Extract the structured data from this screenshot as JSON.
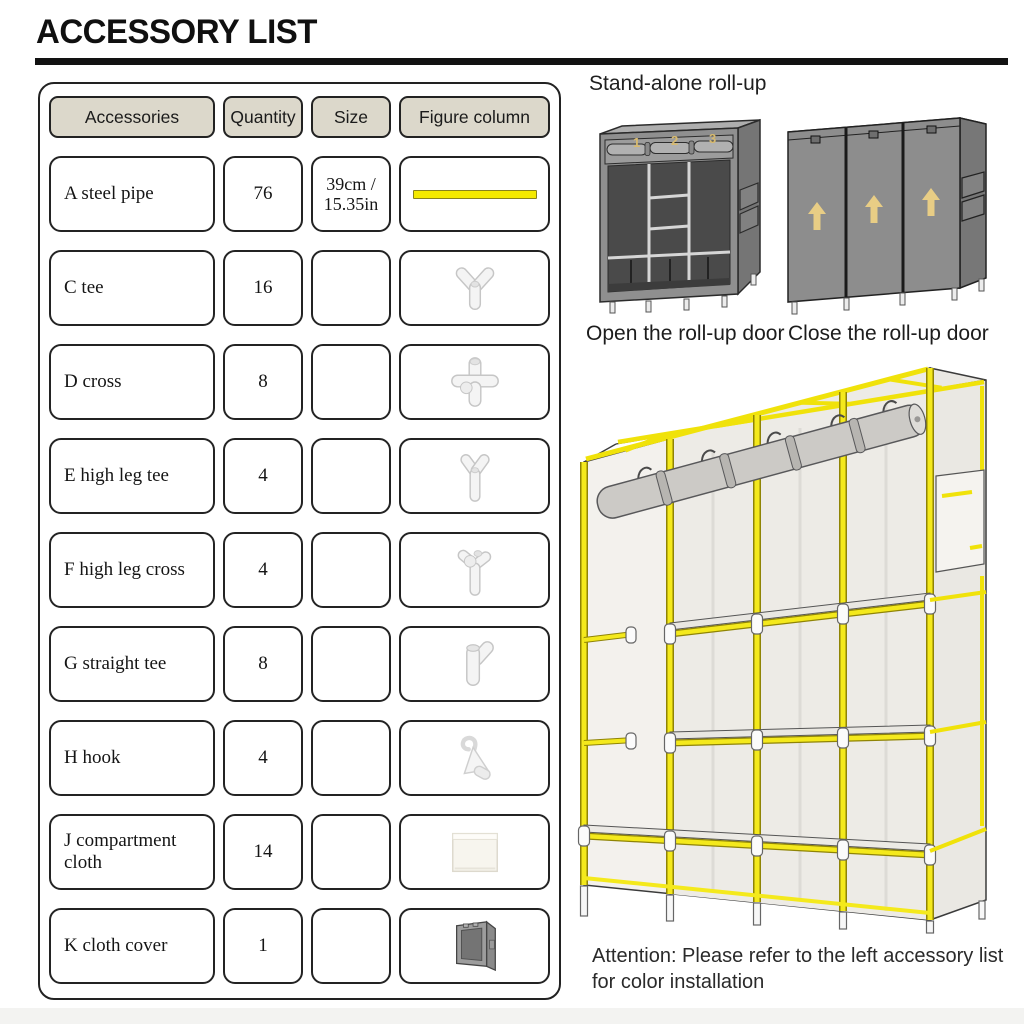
{
  "page": {
    "title": "ACCESSORY LIST",
    "attention": "Attention: Please refer to the left accessory list for color installation"
  },
  "table": {
    "headers": [
      "Accessories",
      "Quantity",
      "Size",
      "Figure column"
    ],
    "rows": [
      {
        "name": "A steel pipe",
        "quantity": "76",
        "size": "39cm / 15.35in",
        "figure": "steel-pipe"
      },
      {
        "name": "C tee",
        "quantity": "16",
        "size": "",
        "figure": "tee-connector"
      },
      {
        "name": "D cross",
        "quantity": "8",
        "size": "",
        "figure": "cross-connector"
      },
      {
        "name": "E high leg tee",
        "quantity": "4",
        "size": "",
        "figure": "high-leg-tee-connector"
      },
      {
        "name": "F high leg cross",
        "quantity": "4",
        "size": "",
        "figure": "high-leg-cross-connector"
      },
      {
        "name": "G straight tee",
        "quantity": "8",
        "size": "",
        "figure": "straight-tee-connector"
      },
      {
        "name": "H hook",
        "quantity": "4",
        "size": "",
        "figure": "hook"
      },
      {
        "name": "J compartment cloth",
        "quantity": "14",
        "size": "",
        "figure": "compartment-cloth"
      },
      {
        "name": "K cloth cover",
        "quantity": "1",
        "size": "",
        "figure": "cloth-cover"
      }
    ]
  },
  "right_panel": {
    "standalone_label": "Stand-alone roll-up",
    "open_caption": "Open the roll-up door",
    "close_caption": "Close the roll-up door",
    "door_numbers": [
      "1",
      "2",
      "3"
    ]
  },
  "colors": {
    "accent_yellow": "#f2e70e",
    "header_bg": "#dcd8cb",
    "wardrobe_gray": "#8d8d8d",
    "arrow_tan": "#e8cd85",
    "text_dark": "#1d1d1f"
  }
}
